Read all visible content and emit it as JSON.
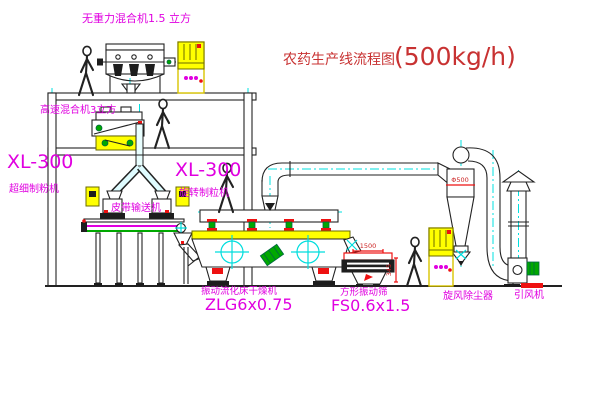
{
  "title": {
    "text": "农药生产线流程图",
    "capacity": "(500kg/h)"
  },
  "diagram_type": "pesticide production line process flow (CAD style)",
  "equipment": {
    "gravity_mixer": {
      "label": "无重力混合机1.5 立方"
    },
    "high_speed_mixer": {
      "label": "高速混合机3立方"
    },
    "mill": {
      "model": "XL-300",
      "name": "超细制粉机"
    },
    "granulator": {
      "model": "XL-300",
      "name": "旋转制粒机"
    },
    "belt_conveyor": {
      "name": "皮带输送机"
    },
    "dryer": {
      "name": "振动流化床干燥机",
      "model": "ZLG6x0.75"
    },
    "sieve": {
      "name": "方形振动筛",
      "model": "FS0.6x1.5",
      "width_dim": "1500",
      "height_dim": "345"
    },
    "cyclone": {
      "name": "旋风除尘器",
      "dia_dim": "Φ500"
    },
    "fan": {
      "name": "引风机"
    }
  },
  "colors": {
    "label_magenta": "#e000e0",
    "title_red": "#c83232",
    "line_dark": "#222222",
    "centerline_cyan": "#00e0e0",
    "fill_yellow": "#ffff00",
    "accent_red": "#ee1111",
    "accent_green": "#00a800"
  }
}
